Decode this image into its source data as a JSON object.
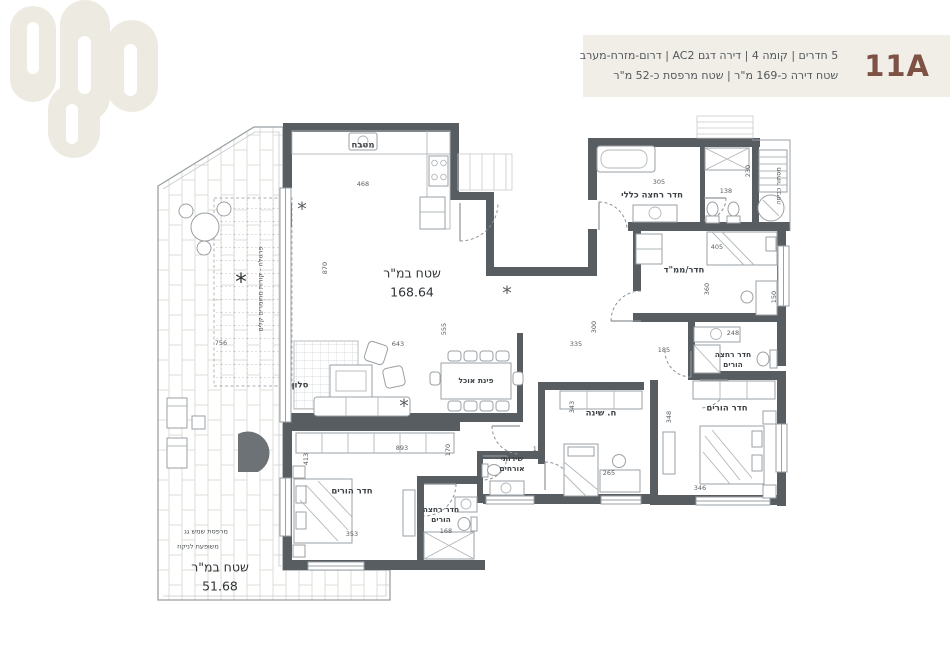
{
  "header": {
    "unit": "11A",
    "line1": "5 חדרים | קומה 4 | דירה דגם AC2 | דרום-מזרח-מערב",
    "line2": "שטח דירה כ-169 מ\"ר | שטח מרפסת כ-52 מ\"ר"
  },
  "theme": {
    "wall": "#585d62",
    "line": "#9aa0a5",
    "light": "#c6cacd",
    "tile": "#dedcd4",
    "accent": "#7d5244",
    "band": "#f0eee7",
    "text": "#53585c",
    "logo": "#edebe1"
  },
  "icons": {
    "plant": "*",
    "star": "*"
  },
  "plan": {
    "labels": [
      {
        "text": "מטבח",
        "x": 363,
        "y": 146
      },
      {
        "text": "סלון",
        "x": 300,
        "y": 386
      },
      {
        "text": "פינת אוכל",
        "x": 476,
        "y": 381,
        "cls": "sm"
      },
      {
        "text": "שירותי\nאורחים",
        "x": 512,
        "y": 464,
        "cls": "sm"
      },
      {
        "text": "ח. שינה",
        "x": 601,
        "y": 414
      },
      {
        "text": "חדר/ממ\"ד",
        "x": 684,
        "y": 271
      },
      {
        "text": "חדר רחצה כללי",
        "x": 652,
        "y": 196
      },
      {
        "text": "חדר רחצה\nהורים",
        "x": 733,
        "y": 360,
        "cls": "sm"
      },
      {
        "text": "חדר הורים",
        "x": 727,
        "y": 409
      },
      {
        "text": "חדר הורים",
        "x": 352,
        "y": 492
      },
      {
        "text": "חדר רחצה\nהורים",
        "x": 441,
        "y": 515,
        "cls": "sm"
      },
      {
        "text": "מסתור כביסה",
        "x": 779,
        "y": 186,
        "cls": "tinyl",
        "rot": -90
      },
      {
        "text": "פרגולה - קורות מחומרים קלים",
        "x": 261,
        "y": 289,
        "cls": "tinyl",
        "rot": -90
      },
      {
        "text": "מרפסת שמש גג",
        "x": 206,
        "y": 532,
        "cls": "tinyl"
      },
      {
        "text": "משופעת לניקוז",
        "x": 198,
        "y": 547,
        "cls": "tinyl"
      },
      {
        "text": "שטח במ\"ר\n168.64",
        "x": 412,
        "y": 283,
        "cls": "area"
      },
      {
        "text": "שטח במ\"ר\n51.68",
        "x": 220,
        "y": 577,
        "cls": "area"
      }
    ],
    "dims": [
      {
        "text": "468",
        "x": 363,
        "y": 184
      },
      {
        "text": "870",
        "x": 325,
        "y": 268,
        "rot": -90
      },
      {
        "text": "643",
        "x": 398,
        "y": 344
      },
      {
        "text": "555",
        "x": 444,
        "y": 329,
        "rot": -90
      },
      {
        "text": "305",
        "x": 659,
        "y": 182
      },
      {
        "text": "138",
        "x": 726,
        "y": 191
      },
      {
        "text": "230",
        "x": 748,
        "y": 171,
        "rot": -90
      },
      {
        "text": "405",
        "x": 717,
        "y": 247
      },
      {
        "text": "360",
        "x": 707,
        "y": 289,
        "rot": -90
      },
      {
        "text": "248",
        "x": 733,
        "y": 333
      },
      {
        "text": "150",
        "x": 774,
        "y": 297,
        "rot": -90
      },
      {
        "text": "185",
        "x": 664,
        "y": 350
      },
      {
        "text": "343",
        "x": 572,
        "y": 407,
        "rot": -90
      },
      {
        "text": "348",
        "x": 669,
        "y": 417,
        "rot": -90
      },
      {
        "text": "346",
        "x": 700,
        "y": 488
      },
      {
        "text": "265",
        "x": 609,
        "y": 473
      },
      {
        "text": "115",
        "x": 539,
        "y": 449
      },
      {
        "text": "335",
        "x": 576,
        "y": 344
      },
      {
        "text": "300",
        "x": 594,
        "y": 327,
        "rot": -90
      },
      {
        "text": "893",
        "x": 402,
        "y": 448
      },
      {
        "text": "170",
        "x": 448,
        "y": 450,
        "rot": -90
      },
      {
        "text": "413",
        "x": 306,
        "y": 459,
        "rot": -90
      },
      {
        "text": "353",
        "x": 352,
        "y": 534
      },
      {
        "text": "168",
        "x": 446,
        "y": 531
      },
      {
        "text": "756",
        "x": 221,
        "y": 343
      }
    ],
    "plants": [
      {
        "g": "*",
        "x": 302,
        "y": 210
      },
      {
        "g": "*",
        "x": 404,
        "y": 407
      },
      {
        "g": "*",
        "x": 507,
        "y": 294
      },
      {
        "g": "*",
        "x": 241,
        "y": 283,
        "cls": "star"
      }
    ]
  }
}
